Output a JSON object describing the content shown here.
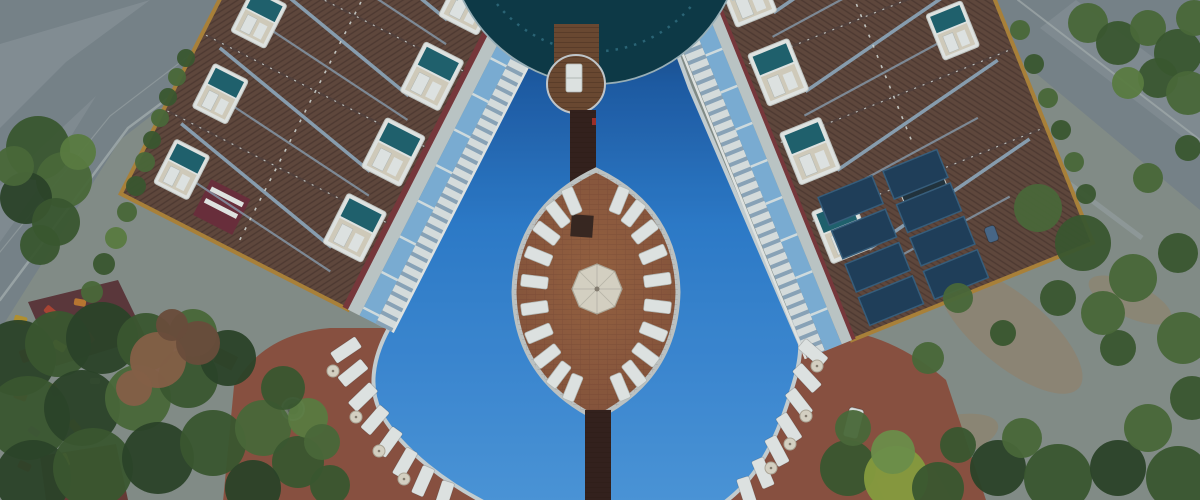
{
  "meta": {
    "title": "Aerial resort hotel with swimming pool",
    "description": "Aerial drone view of a resort hotel: two angled brown-roof wings with dormer balconies around a large blue free-form pool, a curved dark-glass center building, an oval brick island ringed by white sun loungers with a central umbrella, wooden bridges, terracotta pool decks with loungers, roads at the top corners, olive trees and a small playground."
  },
  "palette": {
    "base_ground": "#87918a",
    "road": "#7b868b",
    "road_light": "#97a1a3",
    "curb": "#a9b2b0",
    "dirt": "#97886d",
    "deck": "#8e5340",
    "coping": "#ccd5d6",
    "pool_top": "#14406f",
    "pool_upper": "#1e5da6",
    "pool_mid": "#2e7ecd",
    "pool_low": "#4e9ade",
    "glass": "#0d3a46",
    "glass_mullion": "#2c6878",
    "glass_rim": "#9fb6bc",
    "wood": "#6e4a30",
    "wood_edge": "#c9ced0",
    "plank_line": "rgba(30,16,8,0.35)",
    "bridge": "#35211b",
    "island_brick": "#85523a",
    "island_brick_light": "#9a6340",
    "island_edge": "#c4cac8",
    "brick_line": "rgba(60,30,15,0.18)",
    "dark_square": "#39281f",
    "lounger": "#e7ebe8",
    "lounger_edge": "#b9bfba",
    "cream": "#ded9c8",
    "cream_edge": "#b3ac9a",
    "umbrella_spoke": "rgba(0,0,0,0.12)",
    "roof": "#63493c",
    "roof_line": "rgba(26,16,10,0.25)",
    "trim": "#b08538",
    "eave": "#7c383a",
    "pipe": "#93aec2",
    "ridge": "#55423a",
    "ridge_dash": "#d8dcd6",
    "dormer_frame": "#e9ece8",
    "dormer_teal": "#20646e",
    "dormer_cream": "#d8d2bf",
    "balc_white": "#dfe5e3",
    "balc_slate": "#8fa9bc",
    "terr_water": "#7fb3d8",
    "walkway": "#c2ccca",
    "solar": "#20405a",
    "solar_edge": "#38607e",
    "chimney": "#6d2f3a",
    "skylight": "#22333c",
    "shed_maroon": "#5e383a",
    "shed_dark": "#6a3c34",
    "shed_rust": "#96543c",
    "fountain": "#77826f",
    "fountain_rim": "#a9b0ab",
    "fountain_inner": "#5b6657",
    "pergola": "#6f5138",
    "wall": "#96a09c",
    "red_accent": "#a33028",
    "photo_cast": "#16304a",
    "tree_colors": [
      "#2c4527",
      "#3c5a2e",
      "#4c6c38",
      "#5d7f40",
      "#8ba23e",
      "#70944a",
      "#8a6247",
      "#6e4f3a"
    ]
  },
  "scene": {
    "island": {
      "cx": 596,
      "cy": 294,
      "rx": 84,
      "ry": 124,
      "lounger_count": 24,
      "lounger_rx": 62,
      "lounger_ry": 101,
      "angle_offset": 7,
      "tip_skip_deg": 14
    },
    "umbrella": {
      "cx": 597,
      "cy": 289,
      "r": 25
    },
    "buildings": {
      "sections": 7,
      "dormers_per_column": 7,
      "solar_cols": 2,
      "solar_rows": 4
    },
    "circle_platform_loungers": 1,
    "deck_loungers_left": [
      {
        "x": 346,
        "y": 350,
        "deg": 146
      },
      {
        "x": 353,
        "y": 373,
        "deg": 141
      },
      {
        "x": 363,
        "y": 397,
        "deg": 136
      },
      {
        "x": 375,
        "y": 420,
        "deg": 131
      },
      {
        "x": 389,
        "y": 442,
        "deg": 126
      },
      {
        "x": 405,
        "y": 463,
        "deg": 120
      },
      {
        "x": 423,
        "y": 481,
        "deg": 114
      },
      {
        "x": 444,
        "y": 496,
        "deg": 108
      }
    ],
    "deck_loungers_right": [
      {
        "x": 813,
        "y": 353,
        "deg": 41
      },
      {
        "x": 807,
        "y": 378,
        "deg": 47
      },
      {
        "x": 799,
        "y": 403,
        "deg": 52
      },
      {
        "x": 789,
        "y": 428,
        "deg": 57
      },
      {
        "x": 777,
        "y": 451,
        "deg": 62
      },
      {
        "x": 763,
        "y": 473,
        "deg": 67
      },
      {
        "x": 747,
        "y": 492,
        "deg": 72
      }
    ],
    "deck_umbrellas": [
      {
        "x": 333,
        "y": 371
      },
      {
        "x": 356,
        "y": 417
      },
      {
        "x": 379,
        "y": 451
      },
      {
        "x": 404,
        "y": 479
      },
      {
        "x": 817,
        "y": 366
      },
      {
        "x": 806,
        "y": 416
      },
      {
        "x": 790,
        "y": 444
      },
      {
        "x": 771,
        "y": 468
      }
    ],
    "playground_items": [
      {
        "x": 14,
        "y": 316,
        "w": 13,
        "h": 8,
        "c": "#b8952f",
        "deg": 15
      },
      {
        "x": 44,
        "y": 308,
        "w": 14,
        "h": 8,
        "c": "#b04632",
        "deg": 40
      },
      {
        "x": 74,
        "y": 299,
        "w": 12,
        "h": 7,
        "c": "#c07a30",
        "deg": 10
      },
      {
        "x": 18,
        "y": 352,
        "w": 13,
        "h": 8,
        "c": "#b04632",
        "deg": 70
      },
      {
        "x": 52,
        "y": 342,
        "w": 14,
        "h": 8,
        "c": "#c8a43a",
        "deg": 30
      },
      {
        "x": 84,
        "y": 334,
        "w": 11,
        "h": 7,
        "c": "#a03a2c",
        "deg": 55
      },
      {
        "x": 14,
        "y": 392,
        "w": 13,
        "h": 8,
        "c": "#b03a30",
        "deg": 20
      },
      {
        "x": 48,
        "y": 386,
        "w": 13,
        "h": 8,
        "c": "#c07a30",
        "deg": 65
      },
      {
        "x": 28,
        "y": 428,
        "w": 12,
        "h": 7,
        "c": "#8a5a9c",
        "deg": 35
      },
      {
        "x": 68,
        "y": 422,
        "w": 13,
        "h": 8,
        "c": "#b8952f",
        "deg": 50
      },
      {
        "x": 18,
        "y": 462,
        "w": 13,
        "h": 8,
        "c": "#b04632",
        "deg": 25
      },
      {
        "x": 58,
        "y": 456,
        "w": 13,
        "h": 8,
        "c": "#c8a43a",
        "deg": 70
      },
      {
        "x": 90,
        "y": 378,
        "w": 10,
        "h": 6,
        "c": "#c8c2b0",
        "deg": 0
      }
    ],
    "vehicles": [
      {
        "x": 846,
        "y": 408,
        "w": 15,
        "h": 30,
        "c": "#e2e6e4",
        "deg": 14
      },
      {
        "x": 986,
        "y": 226,
        "w": 11,
        "h": 16,
        "c": "#4a6a8a",
        "deg": -20
      }
    ],
    "trees": [
      {
        "x": 38,
        "y": 148,
        "r": 32,
        "c": 1
      },
      {
        "x": 64,
        "y": 180,
        "r": 28,
        "c": 2
      },
      {
        "x": 26,
        "y": 198,
        "r": 26,
        "c": 0
      },
      {
        "x": 56,
        "y": 222,
        "r": 24,
        "c": 1
      },
      {
        "x": 14,
        "y": 166,
        "r": 20,
        "c": 2
      },
      {
        "x": 78,
        "y": 152,
        "r": 18,
        "c": 3
      },
      {
        "x": 40,
        "y": 245,
        "r": 20,
        "c": 1
      },
      {
        "x": 92,
        "y": 292,
        "r": 11,
        "c": 2
      },
      {
        "x": 104,
        "y": 264,
        "r": 11,
        "c": 1
      },
      {
        "x": 116,
        "y": 238,
        "r": 11,
        "c": 3
      },
      {
        "x": 127,
        "y": 212,
        "r": 10,
        "c": 2
      },
      {
        "x": 136,
        "y": 186,
        "r": 10,
        "c": 1
      },
      {
        "x": 145,
        "y": 162,
        "r": 10,
        "c": 2
      },
      {
        "x": 152,
        "y": 140,
        "r": 9,
        "c": 1
      },
      {
        "x": 160,
        "y": 118,
        "r": 9,
        "c": 2
      },
      {
        "x": 168,
        "y": 97,
        "r": 9,
        "c": 1
      },
      {
        "x": 177,
        "y": 77,
        "r": 9,
        "c": 2
      },
      {
        "x": 186,
        "y": 58,
        "r": 9,
        "c": 1
      },
      {
        "x": 18,
        "y": 358,
        "r": 38,
        "c": 0
      },
      {
        "x": 58,
        "y": 344,
        "r": 33,
        "c": 1
      },
      {
        "x": 102,
        "y": 338,
        "r": 36,
        "c": 0
      },
      {
        "x": 146,
        "y": 342,
        "r": 29,
        "c": 1
      },
      {
        "x": 28,
        "y": 418,
        "r": 42,
        "c": 1
      },
      {
        "x": 82,
        "y": 408,
        "r": 38,
        "c": 0
      },
      {
        "x": 138,
        "y": 398,
        "r": 33,
        "c": 2
      },
      {
        "x": 188,
        "y": 378,
        "r": 30,
        "c": 1
      },
      {
        "x": 228,
        "y": 358,
        "r": 28,
        "c": 0
      },
      {
        "x": 33,
        "y": 478,
        "r": 38,
        "c": 0
      },
      {
        "x": 93,
        "y": 468,
        "r": 40,
        "c": 1
      },
      {
        "x": 158,
        "y": 458,
        "r": 36,
        "c": 0
      },
      {
        "x": 213,
        "y": 443,
        "r": 33,
        "c": 1
      },
      {
        "x": 263,
        "y": 428,
        "r": 28,
        "c": 2
      },
      {
        "x": 298,
        "y": 462,
        "r": 26,
        "c": 1
      },
      {
        "x": 253,
        "y": 488,
        "r": 28,
        "c": 0
      },
      {
        "x": 308,
        "y": 418,
        "r": 20,
        "c": 3
      },
      {
        "x": 193,
        "y": 333,
        "r": 24,
        "c": 2
      },
      {
        "x": 283,
        "y": 388,
        "r": 22,
        "c": 1
      },
      {
        "x": 322,
        "y": 442,
        "r": 18,
        "c": 2
      },
      {
        "x": 330,
        "y": 485,
        "r": 20,
        "c": 1
      },
      {
        "x": 158,
        "y": 360,
        "r": 28,
        "c": 6
      },
      {
        "x": 198,
        "y": 343,
        "r": 22,
        "c": 7
      },
      {
        "x": 134,
        "y": 388,
        "r": 18,
        "c": 6
      },
      {
        "x": 172,
        "y": 325,
        "r": 16,
        "c": 7
      },
      {
        "x": 848,
        "y": 468,
        "r": 28,
        "c": 1
      },
      {
        "x": 896,
        "y": 478,
        "r": 32,
        "c": 4
      },
      {
        "x": 893,
        "y": 452,
        "r": 22,
        "c": 5
      },
      {
        "x": 938,
        "y": 488,
        "r": 26,
        "c": 1
      },
      {
        "x": 853,
        "y": 428,
        "r": 18,
        "c": 2
      },
      {
        "x": 998,
        "y": 468,
        "r": 28,
        "c": 0
      },
      {
        "x": 1058,
        "y": 478,
        "r": 34,
        "c": 1
      },
      {
        "x": 1118,
        "y": 468,
        "r": 28,
        "c": 0
      },
      {
        "x": 1178,
        "y": 478,
        "r": 32,
        "c": 1
      },
      {
        "x": 1148,
        "y": 428,
        "r": 24,
        "c": 2
      },
      {
        "x": 1192,
        "y": 398,
        "r": 22,
        "c": 1
      },
      {
        "x": 1183,
        "y": 338,
        "r": 26,
        "c": 2
      },
      {
        "x": 1118,
        "y": 348,
        "r": 18,
        "c": 1
      },
      {
        "x": 1022,
        "y": 438,
        "r": 20,
        "c": 2
      },
      {
        "x": 958,
        "y": 445,
        "r": 18,
        "c": 1
      },
      {
        "x": 1038,
        "y": 208,
        "r": 24,
        "c": 2
      },
      {
        "x": 1083,
        "y": 243,
        "r": 28,
        "c": 1
      },
      {
        "x": 1133,
        "y": 278,
        "r": 24,
        "c": 2
      },
      {
        "x": 1178,
        "y": 253,
        "r": 20,
        "c": 1
      },
      {
        "x": 1058,
        "y": 298,
        "r": 18,
        "c": 1
      },
      {
        "x": 1103,
        "y": 313,
        "r": 22,
        "c": 2
      },
      {
        "x": 958,
        "y": 298,
        "r": 15,
        "c": 2
      },
      {
        "x": 1003,
        "y": 333,
        "r": 13,
        "c": 1
      },
      {
        "x": 928,
        "y": 358,
        "r": 16,
        "c": 2
      },
      {
        "x": 1148,
        "y": 178,
        "r": 15,
        "c": 2
      },
      {
        "x": 1188,
        "y": 148,
        "r": 13,
        "c": 1
      },
      {
        "x": 1088,
        "y": 23,
        "r": 20,
        "c": 2
      },
      {
        "x": 1118,
        "y": 43,
        "r": 22,
        "c": 1
      },
      {
        "x": 1148,
        "y": 28,
        "r": 18,
        "c": 2
      },
      {
        "x": 1178,
        "y": 53,
        "r": 24,
        "c": 1
      },
      {
        "x": 1194,
        "y": 18,
        "r": 18,
        "c": 2
      },
      {
        "x": 1158,
        "y": 78,
        "r": 20,
        "c": 1
      },
      {
        "x": 1188,
        "y": 93,
        "r": 22,
        "c": 2
      },
      {
        "x": 1128,
        "y": 83,
        "r": 16,
        "c": 3
      },
      {
        "x": 1020,
        "y": 30,
        "r": 10,
        "c": 2
      },
      {
        "x": 1034,
        "y": 64,
        "r": 10,
        "c": 1
      },
      {
        "x": 1048,
        "y": 98,
        "r": 10,
        "c": 2
      },
      {
        "x": 1061,
        "y": 130,
        "r": 10,
        "c": 1
      },
      {
        "x": 1074,
        "y": 162,
        "r": 10,
        "c": 2
      },
      {
        "x": 1086,
        "y": 194,
        "r": 10,
        "c": 1
      }
    ]
  }
}
